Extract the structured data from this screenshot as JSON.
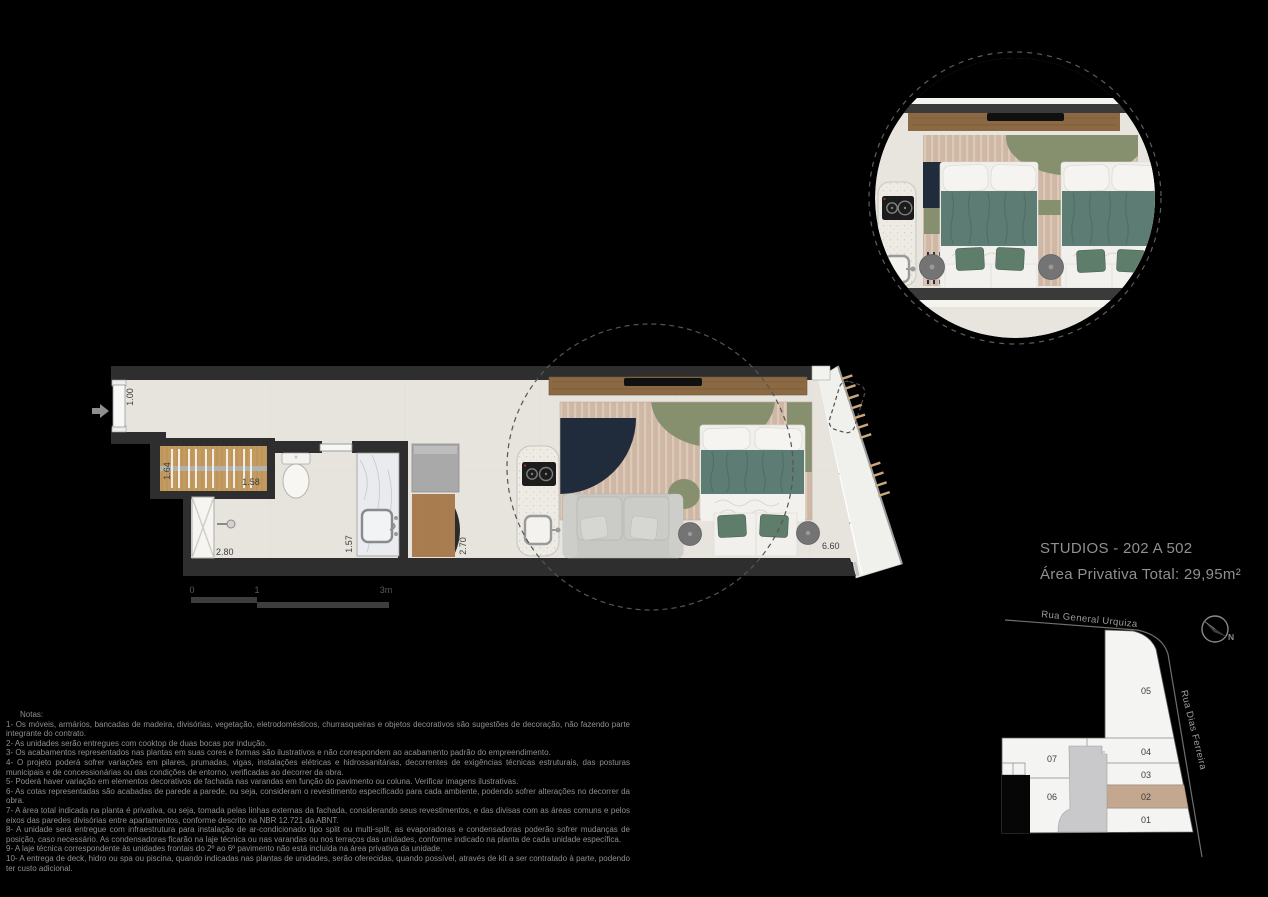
{
  "page": {
    "background": "#000000"
  },
  "title_block": {
    "title": "STUDIOS - 202 A 502",
    "subtitle": "Área Privativa Total: 29,95m²"
  },
  "floor_plan": {
    "dimensions": {
      "entry_hall_width": "1.00",
      "wardrobe_depth": "1.64",
      "wardrobe_width": "1.58",
      "bathroom_length": "2.80",
      "bathroom_counter": "1.57",
      "kitchen_counter": "2.70",
      "living_length": "6.60"
    },
    "scale_bar": {
      "tick_zero": "0",
      "tick_one": "1",
      "tick_three": "3m"
    }
  },
  "site_plan": {
    "street_top": "Rua General Urquiza",
    "street_right": "Rua Dias Ferreira",
    "north_label": "N",
    "highlighted_unit": "02",
    "highlight_color": "#c3a78f",
    "units": {
      "u01": "01",
      "u02": "02",
      "u03": "03",
      "u04": "04",
      "u05": "05",
      "u06": "06",
      "u07": "07"
    }
  },
  "notes": {
    "heading": "Notas:",
    "items": [
      "1- Os móveis, armários, bancadas de madeira, divisórias, vegetação, eletrodomésticos, churrasqueiras e objetos decorativos são sugestões de decoração, não fazendo parte integrante do contrato.",
      "2- As unidades serão entregues com cooktop de duas bocas por indução.",
      "3- Os acabamentos  representados nas plantas em suas cores e formas são ilustrativos e não  correspondem ao acabamento padrão do  empreendimento.",
      "4- O projeto poderá sofrer variações em pilares,  prumadas,  vigas,  instalações elétricas e hidrossanitárias,  decorrentes de exigências técnicas estruturais, das posturas municipais e de concessionárias ou das condições de entorno, verificadas ao decorrer da obra.",
      "5- Poderá haver variação em elementos decorativos de fachada nas varandas em função do pavimento ou coluna. Verificar imagens ilustrativas.",
      "6- As  cotas  representadas  são  acabadas  de parede a  parede, ou seja,  consideram o revestimento  especificado para cada  ambiente,  podendo  sofrer alterações no decorrer da obra.",
      "7- A área  total indicada  na planta é privativa, ou seja,  tomada pelas linhas externas da fachada,  considerando seus revestimentos, e das divisas  com as áreas comuns e pelos eixos das paredes divisórias entre apartamentos, conforme descrito na NBR 12.721 da ABNT.",
      "8- A unidade será entregue com infraestrutura para instalação de ar-condicionado tipo split ou multi-split, as evaporadoras e condensadoras poderão sofrer mudanças  de posição, caso necessário.  As condensadoras ficarão na laje técnica ou  nas varandas ou nos terraços das unidades,  conforme indicado na planta de cada unidade específica.",
      "9- A laje técnica correspondente às unidades frontais do 2º ao 6º pavimento não está incluída na área privativa da unidade.",
      "10- A  entrega  de  deck,  hidro ou spa ou piscina,  quando  indicadas  nas plantas de unidades,  serão  oferecidas,  quando  possível,  através  de kit a  ser contratado à parte, podendo ter custo adicional."
    ]
  }
}
